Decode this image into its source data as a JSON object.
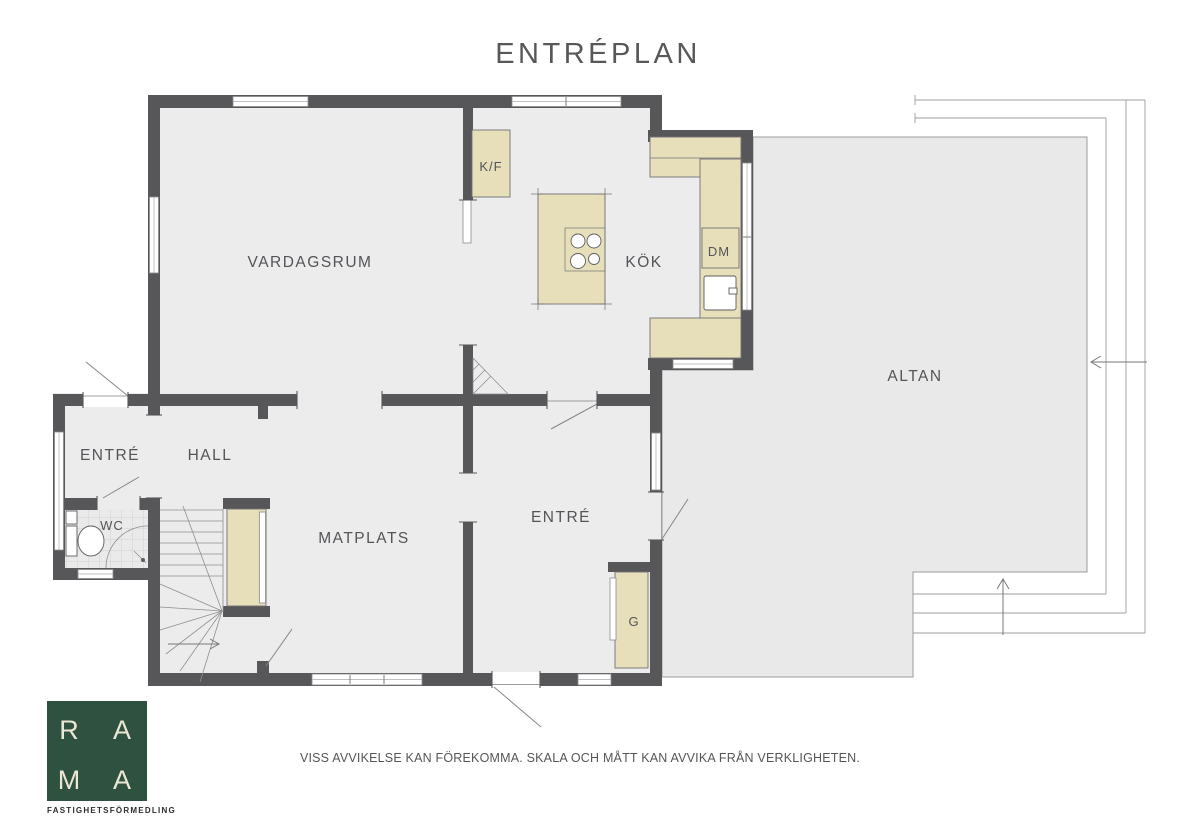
{
  "title": "ENTRÉPLAN",
  "plan": {
    "rooms": {
      "vardagsrum": "VARDAGSRUM",
      "kok": "KÖK",
      "matplats": "MATPLATS",
      "hall": "HALL",
      "entre_west": "ENTRÉ",
      "entre_south": "ENTRÉ",
      "wc": "WC",
      "altan": "ALTAN"
    },
    "fixtures": {
      "fridge_freezer": "K/F",
      "dishwasher": "DM",
      "wardrobe": "G"
    }
  },
  "footer": {
    "disclaimer": "VISS AVVIKELSE KAN FÖREKOMMA. SKALA OCH MÅTT KAN AVVIKA FRÅN VERKLIGHETEN."
  },
  "logo": {
    "letters": [
      "R",
      "A",
      "M",
      "A"
    ],
    "subtitle": "FASTIGHETSFÖRMEDLING"
  },
  "colors": {
    "wall": "#57575a",
    "floor": "#ececec",
    "deck": "#e9e9e9",
    "fixture": "#e7dfba",
    "logo_green": "#2e5140",
    "text": "#58585a"
  }
}
